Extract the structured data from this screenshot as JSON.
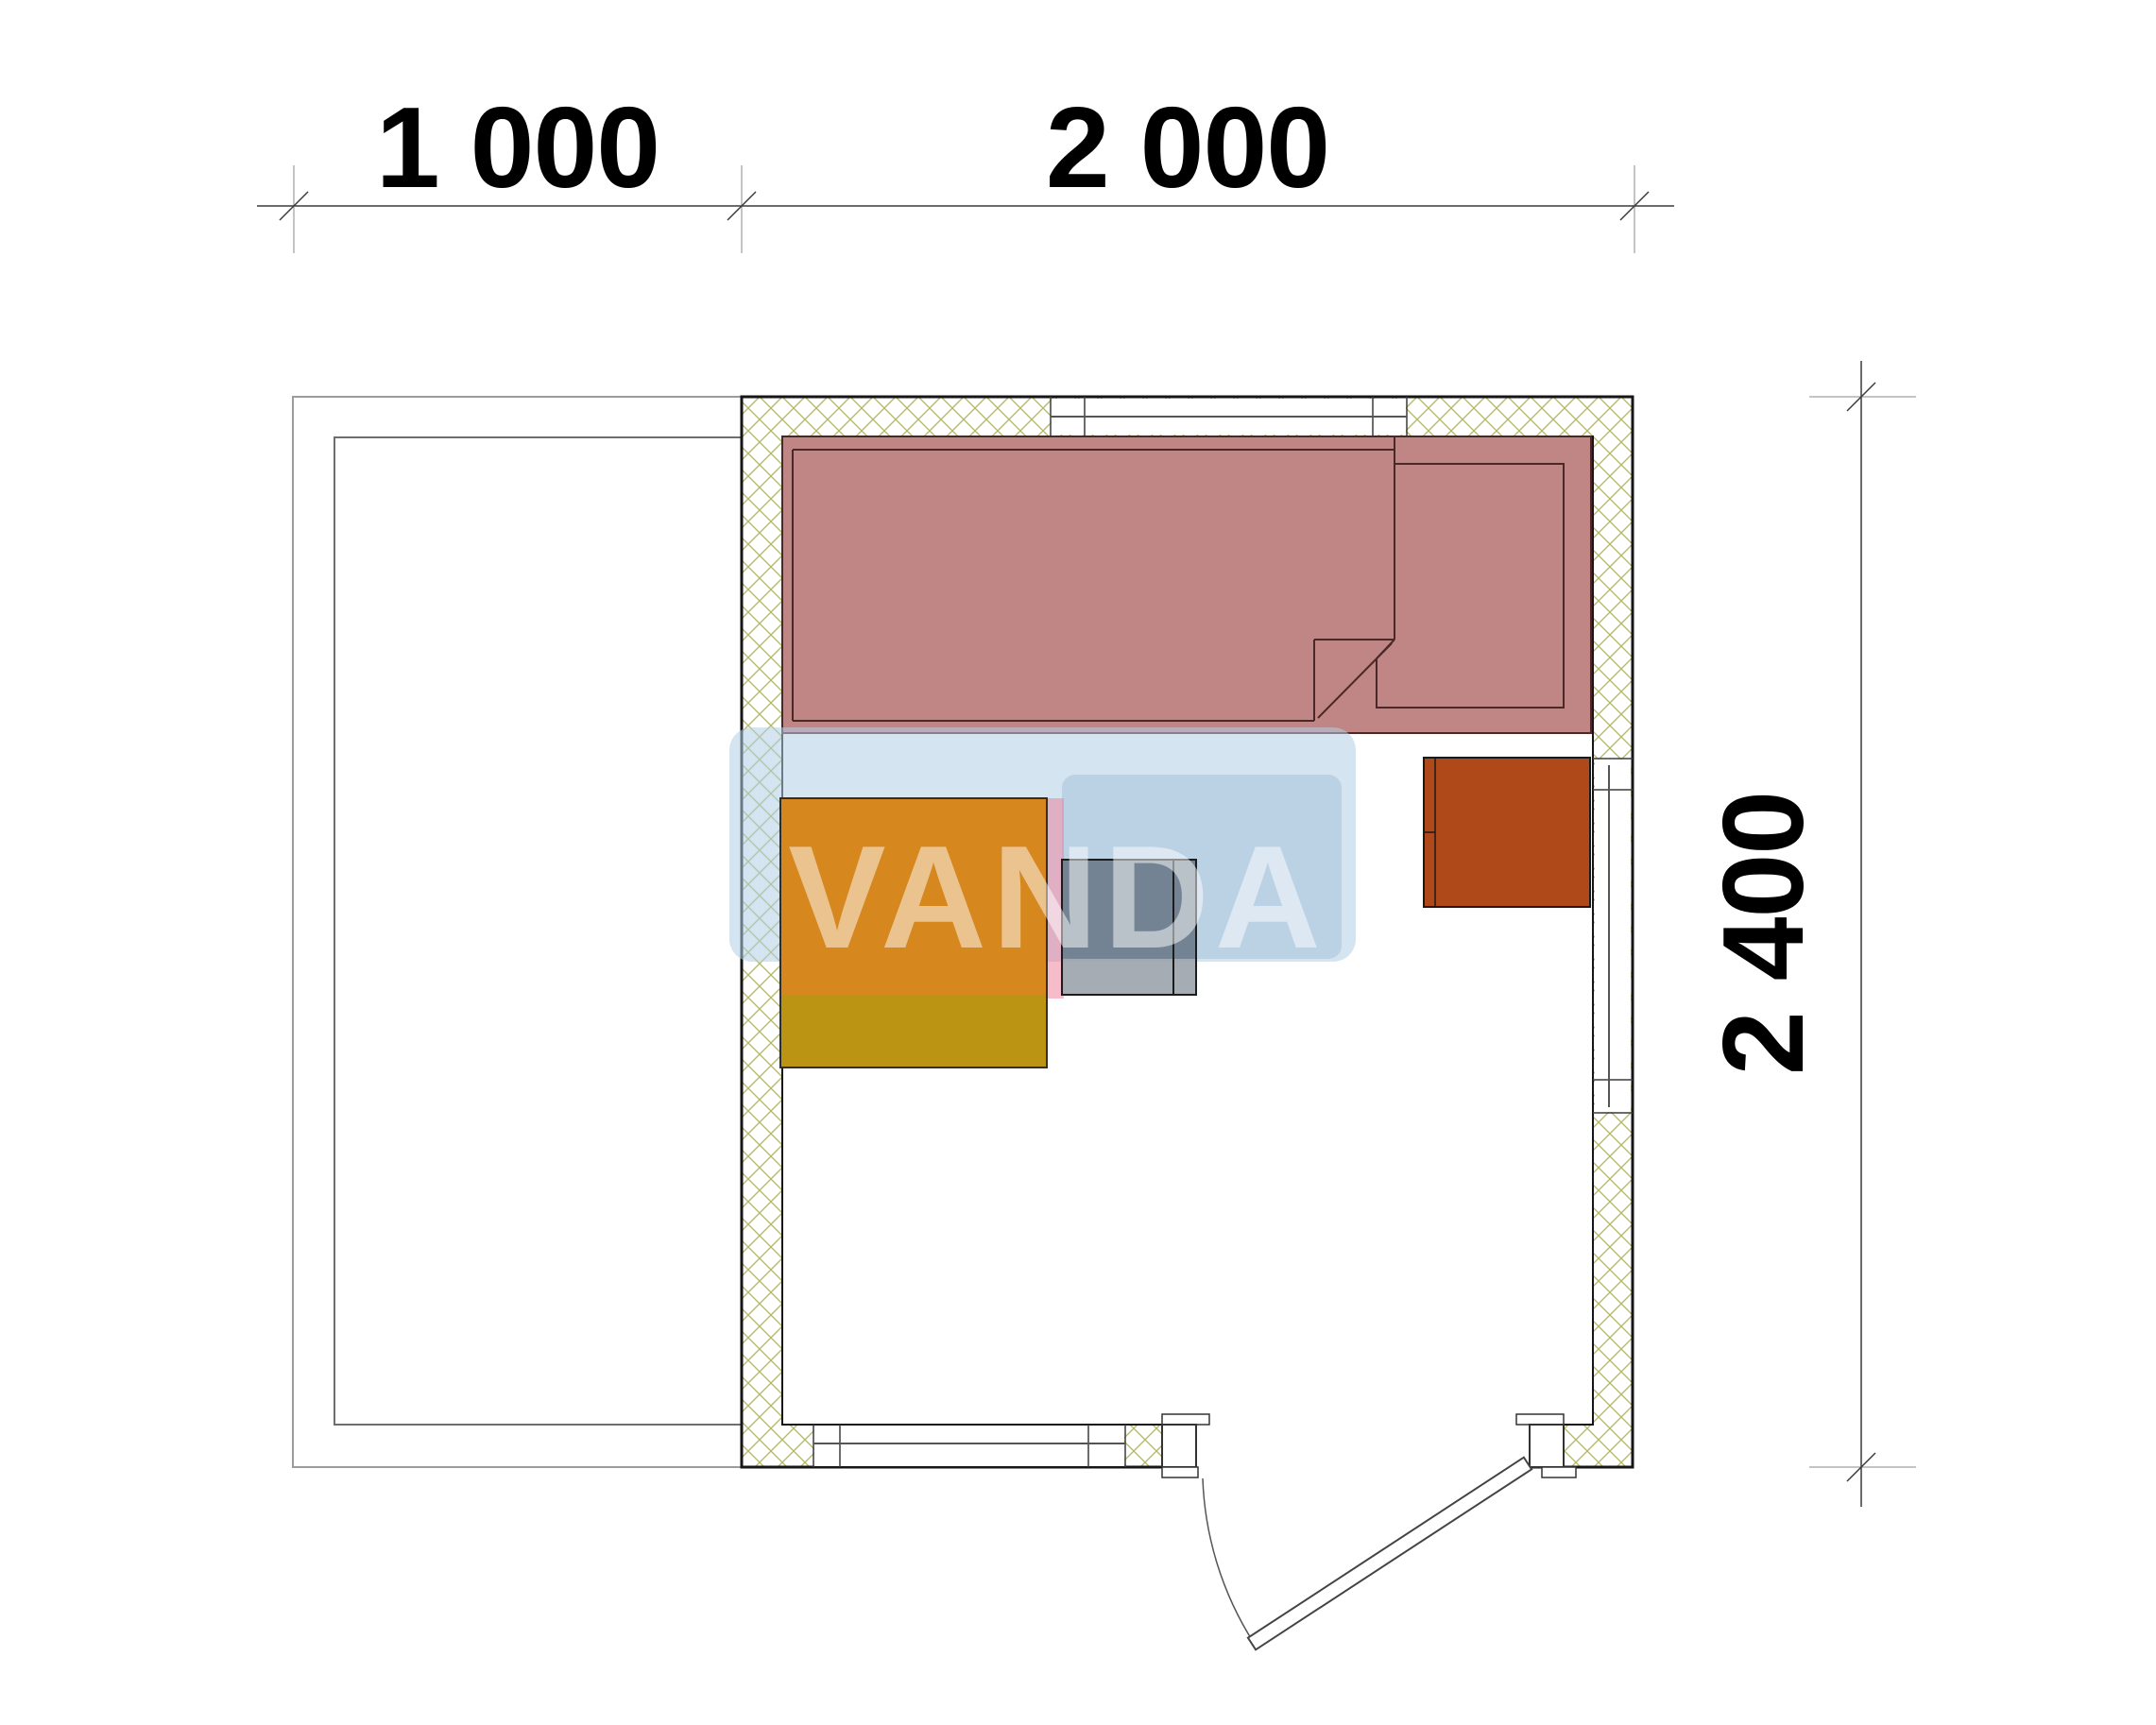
{
  "drawing": {
    "type": "architectural floor plan",
    "dimensions": {
      "top": [
        {
          "label": "1 000"
        },
        {
          "label": "2 000"
        }
      ],
      "right": {
        "label": "2 400"
      }
    },
    "watermark": {
      "text": "VANDA"
    },
    "colors": {
      "bench_fill": "#c08686",
      "bench_line": "#4a2828",
      "table_top": "#d6871e",
      "table_bottom": "#bc9414",
      "stove_body": "#6c7a8a",
      "stove_base": "#9ba3ab",
      "heater": "#b0491a",
      "hatch": "#b6ba6a",
      "wm_box": "#b1cee4",
      "wm_panel": "#8cafcd",
      "wm_pink": "#ed7995"
    }
  }
}
